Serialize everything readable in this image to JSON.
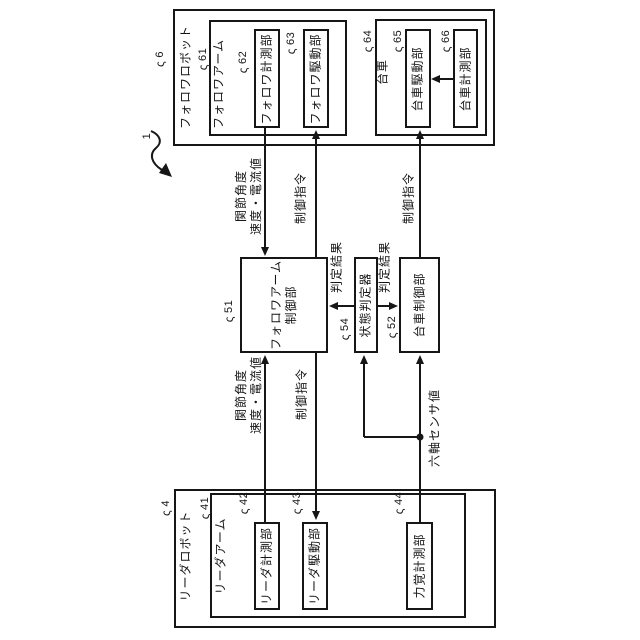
{
  "diagram": {
    "system_ref": "1",
    "lead_glyph": "ς",
    "ink": "#161616",
    "bg": "#ffffff",
    "blocks": {
      "follower_robot": {
        "label": "フォロワロボット",
        "ref": "6"
      },
      "follower_arm": {
        "label": "フォロワアーム",
        "ref": "61"
      },
      "follower_meas": {
        "label": "フォロワ計測部",
        "ref": "62"
      },
      "follower_drive": {
        "label": "フォロワ駆動部",
        "ref": "63"
      },
      "cart": {
        "label": "台車",
        "ref": "64"
      },
      "cart_drive": {
        "label": "台車駆動部",
        "ref": "65"
      },
      "cart_meas": {
        "label": "台車計測部",
        "ref": "66"
      },
      "follower_arm_ctrl": {
        "label": "フォロワアーム\n制御部",
        "ref": "51"
      },
      "state_judge": {
        "label": "状態判定器",
        "ref": "54"
      },
      "cart_ctrl": {
        "label": "台車制御部",
        "ref": "52"
      },
      "leader_robot": {
        "label": "リーダロボット",
        "ref": "4"
      },
      "leader_arm": {
        "label": "リーダアーム",
        "ref": "41"
      },
      "leader_meas": {
        "label": "リーダ計測部",
        "ref": "42"
      },
      "leader_drive": {
        "label": "リーダ駆動部",
        "ref": "43"
      },
      "force_meas": {
        "label": "力覚計測部",
        "ref": "44"
      }
    },
    "flows": {
      "joint_state_upper": "関節角度\n速度・電流値",
      "ctrl_cmd_follower": "制御指令",
      "ctrl_cmd_cart": "制御指令",
      "judge_result_left": "判定結果",
      "judge_result_right": "判定結果",
      "joint_state_lower": "関節角度\n速度・電流値",
      "ctrl_cmd_leader": "制御指令",
      "six_axis_sensor": "六軸センサ値"
    }
  }
}
